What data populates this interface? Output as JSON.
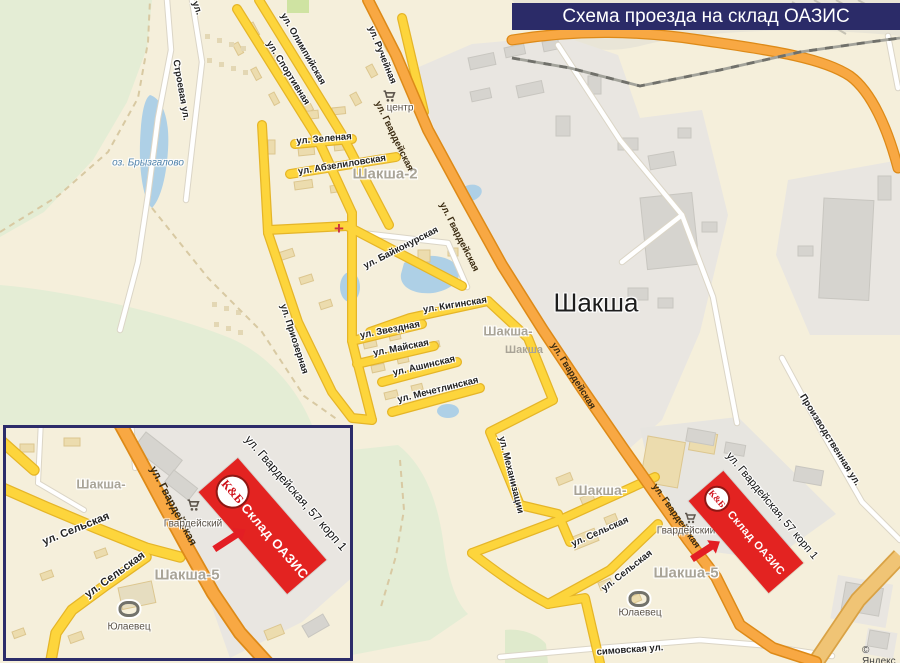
{
  "banner": {
    "title": "Схема проезда на склад ОАЗИС"
  },
  "attribution": "© Яндекс",
  "warehouse": {
    "brand": "К&Б",
    "name": "Склад ОАЗИС",
    "address": "ул. Гвардейская, 57 корп 1"
  },
  "streets": {
    "gvardeyskaya": "ул. Гвардейская",
    "olimpiyskaya": "ул. Олимпийская",
    "sportivnaya": "ул. Спортивная",
    "rucheynaya": "ул. Ручейная",
    "stroevaya": "Строевая ул.",
    "ul_fragment": "ул.",
    "zelenaya": "ул. Зеленая",
    "abzelilovskaya": "ул. Абзелиловская",
    "baykonurskaya": "ул. Байконурская",
    "priozernaya": "ул. Приозерная",
    "kiginskaya": "ул. Кигинская",
    "zvezdnaya": "ул. Звездная",
    "mayskaya": "ул. Майская",
    "ashinskaya": "ул. Ашинская",
    "mechetlinskaya": "ул. Мечетлинская",
    "mekhanizatsii": "ул. Механизации",
    "selskaya": "ул. Сельская",
    "proizvodstvennaya": "Производственная ул.",
    "maksimovskaya": "симовская ул."
  },
  "places": {
    "shaksha": "Шакша",
    "shaksha2": "Шакша-2",
    "shaksha_partial": "Шакша-",
    "shaksha_station": "Шакша",
    "shaksha5": "Шакша-5",
    "lake": "оз. Брызгалово",
    "shopping_center": "центр",
    "gvardeysky": "Гвардейский",
    "yulaevets": "Юлаевец"
  },
  "colors": {
    "banner_bg": "#2b2b68",
    "warehouse_red": "#e32321",
    "kb_red": "#cf1019",
    "road_main_fill": "#f8a843",
    "road_secondary_fill": "#fdd53c",
    "water": "#aed0e6",
    "green": "#e4edd5",
    "industrial": "#e9e6e1"
  }
}
